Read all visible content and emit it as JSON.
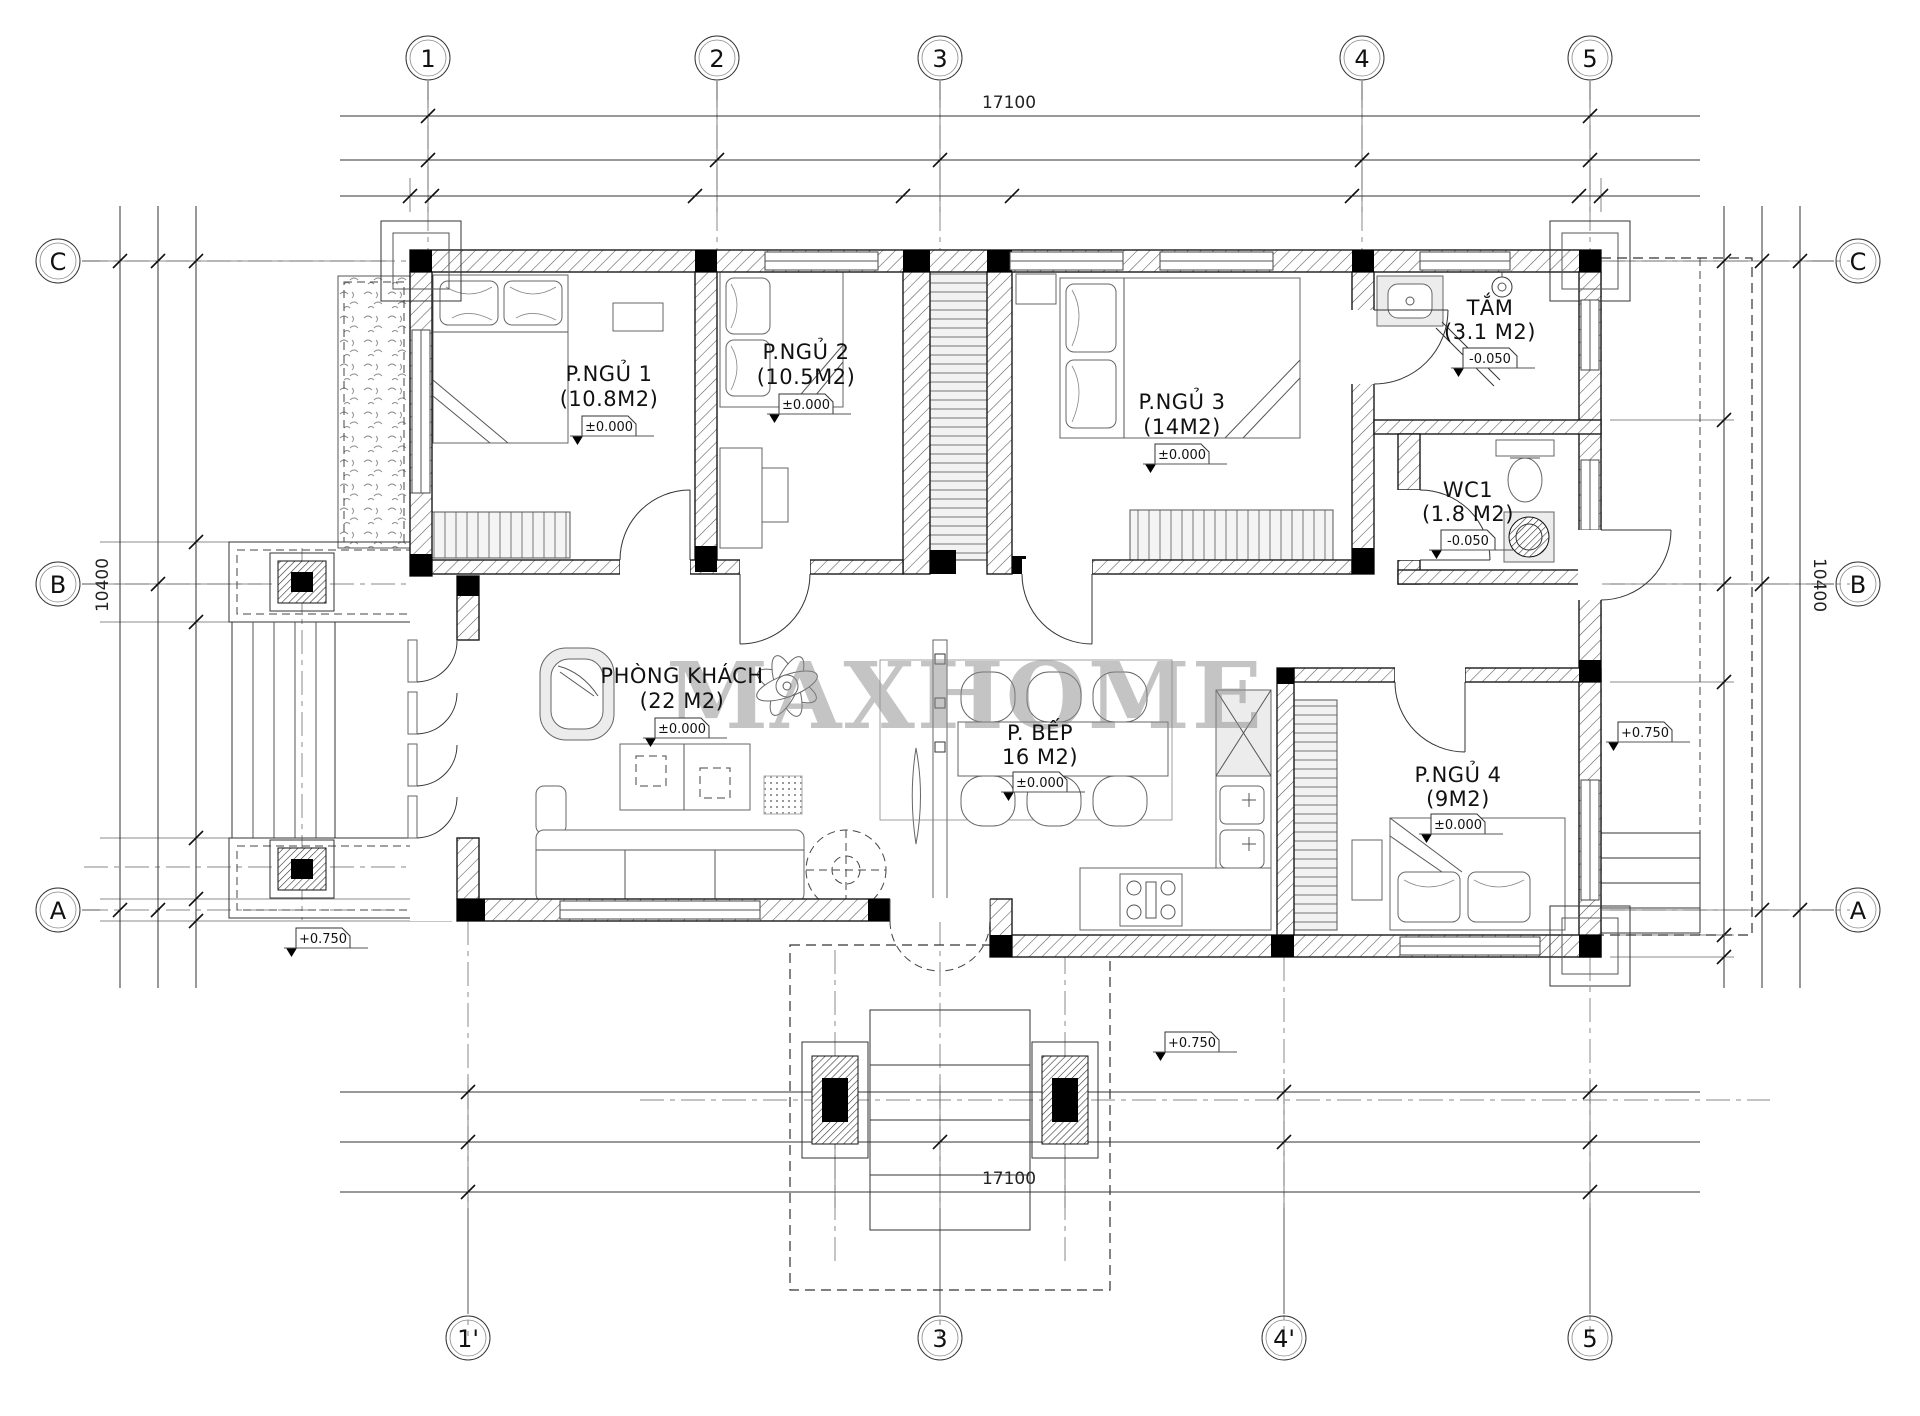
{
  "document": {
    "watermark": "MAXHOME"
  },
  "grid": {
    "top": [
      "1",
      "2",
      "3",
      "4",
      "5"
    ],
    "bottom": [
      "1'",
      "3",
      "4'",
      "5"
    ],
    "left": [
      "C",
      "B",
      "A"
    ],
    "right": [
      "C",
      "B",
      "A"
    ]
  },
  "dimensions": {
    "top_total": "17100",
    "bottom_total": "17100",
    "left_total": "10400",
    "right_total": "10400"
  },
  "rooms": {
    "bedroom1": {
      "name": "P.NGỦ 1",
      "area": "(10.8M2)",
      "level": "±0.000"
    },
    "bedroom2": {
      "name": "P.NGỦ 2",
      "area": "(10.5M2)",
      "level": "±0.000"
    },
    "bedroom3": {
      "name": "P.NGỦ 3",
      "area": "(14M2)",
      "level": "±0.000"
    },
    "bathroom": {
      "name": "TẮM",
      "area": "(3.1 M2)",
      "level": "-0.050"
    },
    "wc1": {
      "name": "WC1",
      "area": "(1.8 M2)",
      "level": "-0.050"
    },
    "living_room": {
      "name": "PHÒNG KHÁCH",
      "area": "(22 M2)",
      "level": "±0.000"
    },
    "kitchen": {
      "name": "P. BẾP",
      "area": "16 M2)",
      "level": "±0.000"
    },
    "bedroom4": {
      "name": "P.NGỦ 4",
      "area": "(9M2)",
      "level": "±0.000"
    }
  },
  "site_levels": {
    "left_porch": "+0.750",
    "front_entrance": "+0.750",
    "right_terrace": "+0.750"
  }
}
